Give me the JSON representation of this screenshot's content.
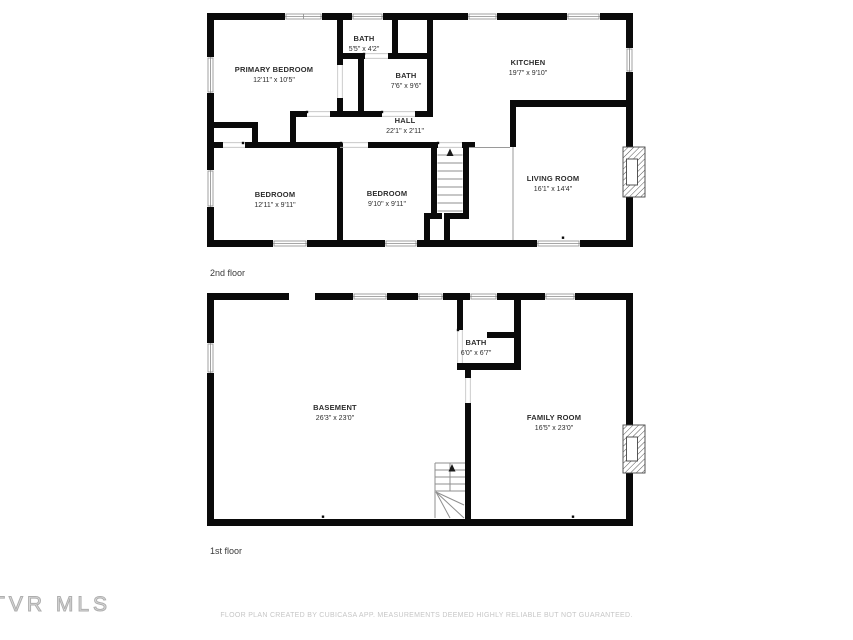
{
  "page": {
    "background": "#ffffff"
  },
  "colors": {
    "wall": "#0a0a0a",
    "window_frame": "#8a8a8a",
    "stair_line": "#8f8f8f",
    "label_text": "#2d2d2d",
    "footer_text": "#c6c6c6",
    "watermark_text": "#c0c0c0"
  },
  "floors": [
    {
      "tag": "2nd floor",
      "rooms": [
        {
          "name": "PRIMARY BEDROOM",
          "dims": "12'11\" x 10'5\"",
          "cx": 274,
          "cy": 70
        },
        {
          "name": "BATH",
          "dims": "5'5\" x 4'2\"",
          "cx": 364,
          "cy": 39
        },
        {
          "name": "BATH",
          "dims": "7'6\" x 9'6\"",
          "cx": 406,
          "cy": 76
        },
        {
          "name": "KITCHEN",
          "dims": "19'7\" x 9'10\"",
          "cx": 528,
          "cy": 63
        },
        {
          "name": "HALL",
          "dims": "22'1\" x 2'11\"",
          "cx": 405,
          "cy": 121
        },
        {
          "name": "BEDROOM",
          "dims": "12'11\" x 9'11\"",
          "cx": 275,
          "cy": 195
        },
        {
          "name": "BEDROOM",
          "dims": "9'10\" x 9'11\"",
          "cx": 387,
          "cy": 194
        },
        {
          "name": "LIVING ROOM",
          "dims": "16'1\" x 14'4\"",
          "cx": 553,
          "cy": 179
        }
      ]
    },
    {
      "tag": "1st floor",
      "rooms": [
        {
          "name": "BATH",
          "dims": "6'0\" x 6'7\"",
          "cx": 476,
          "cy": 343
        },
        {
          "name": "BASEMENT",
          "dims": "26'3\" x 23'0\"",
          "cx": 335,
          "cy": 408
        },
        {
          "name": "FAMILY ROOM",
          "dims": "16'5\" x 23'0\"",
          "cx": 554,
          "cy": 418
        }
      ]
    }
  ],
  "watermark": "TVR MLS",
  "footer": "FLOOR PLAN CREATED BY CUBICASA APP. MEASUREMENTS DEEMED HIGHLY RELIABLE BUT NOT GUARANTEED."
}
